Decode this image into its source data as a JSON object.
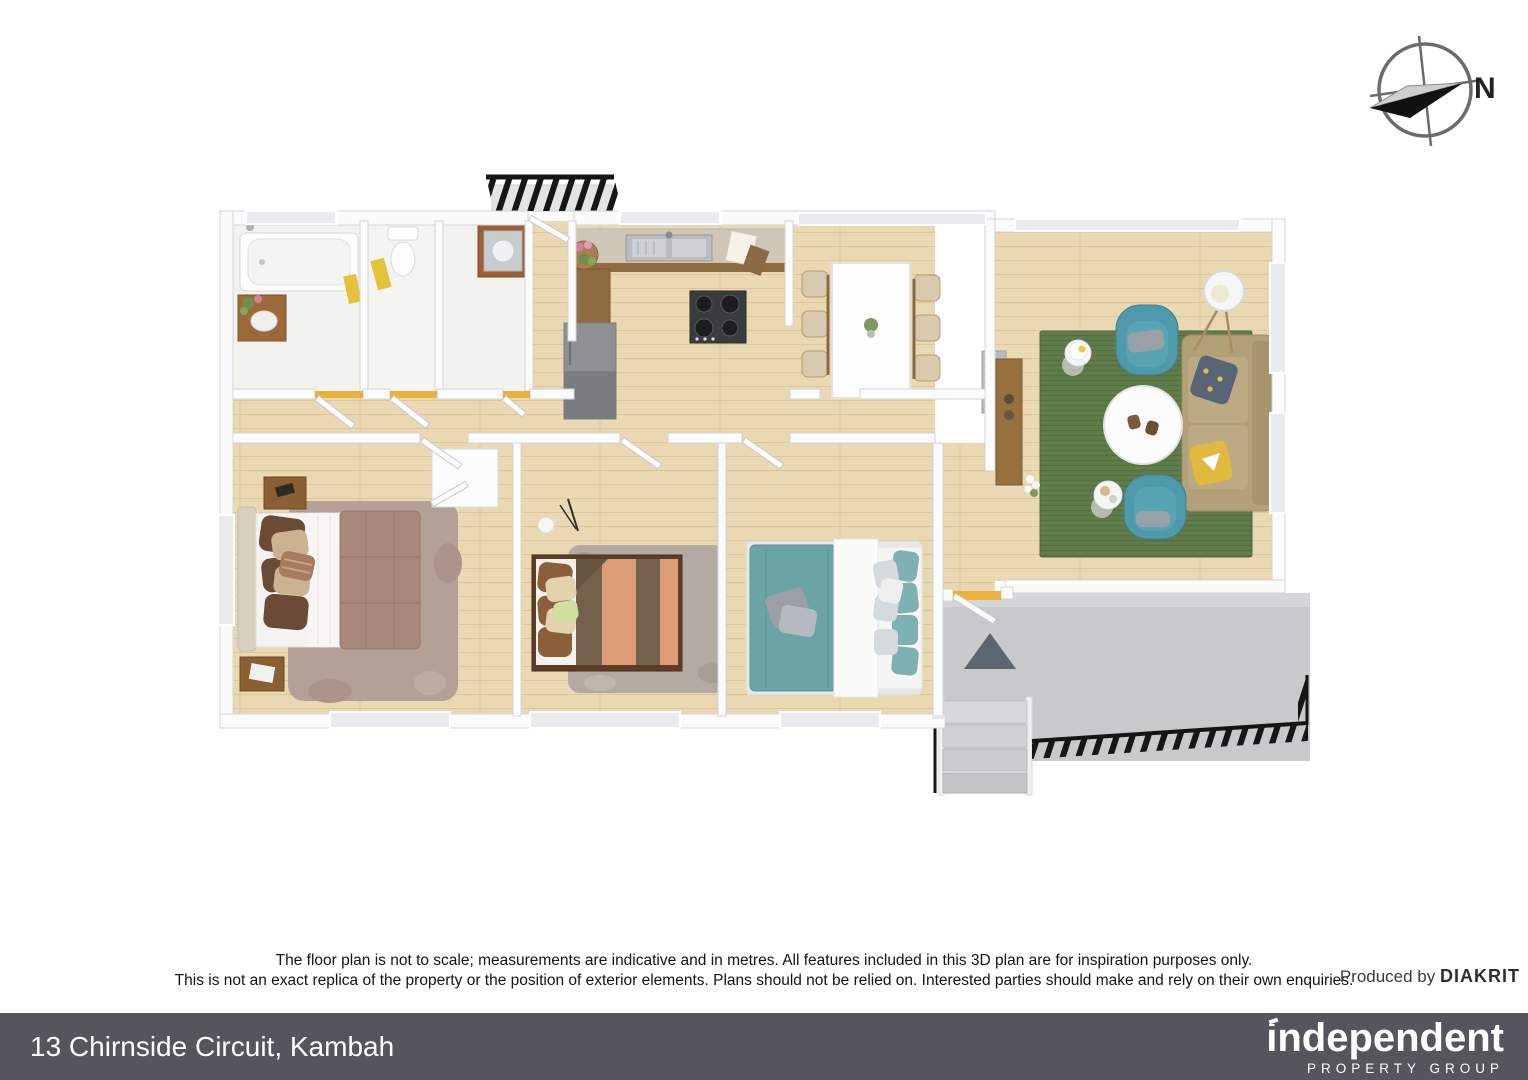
{
  "compass": {
    "label": "N"
  },
  "disclaimer": {
    "line1": "The floor plan is not to scale; measurements are indicative and in metres. All features included in this 3D plan are for inspiration purposes only.",
    "line2": "This is not an exact replica of the property or the position of exterior elements. Plans should not be relied on. Interested parties should make and rely on their own enquiries.",
    "produced_by_prefix": "Produced by",
    "produced_by_brand": "DIAKRIT"
  },
  "footer": {
    "address": "13 Chirnside Circuit, Kambah",
    "brand_name": "independent",
    "brand_tagline": "PROPERTY GROUP"
  },
  "colors": {
    "footer_bar": "#54565e",
    "wall_white": "#fbfbfc",
    "wood_floor": "#ead8b2",
    "wet_room_floor": "#f2f2ef",
    "rug_green": "#617c4b",
    "sofa_tan": "#b2a078",
    "armchair_teal": "#4f9aaa",
    "bed_brown": "#a8897d",
    "bed_orange": "#dd9d77",
    "bed_teal": "#6ba4a6",
    "deck_gray": "#c7c9cb",
    "railing_black": "#161616",
    "threshold_yellow": "#e9b23c",
    "cabinet_brown": "#8f6b42"
  }
}
